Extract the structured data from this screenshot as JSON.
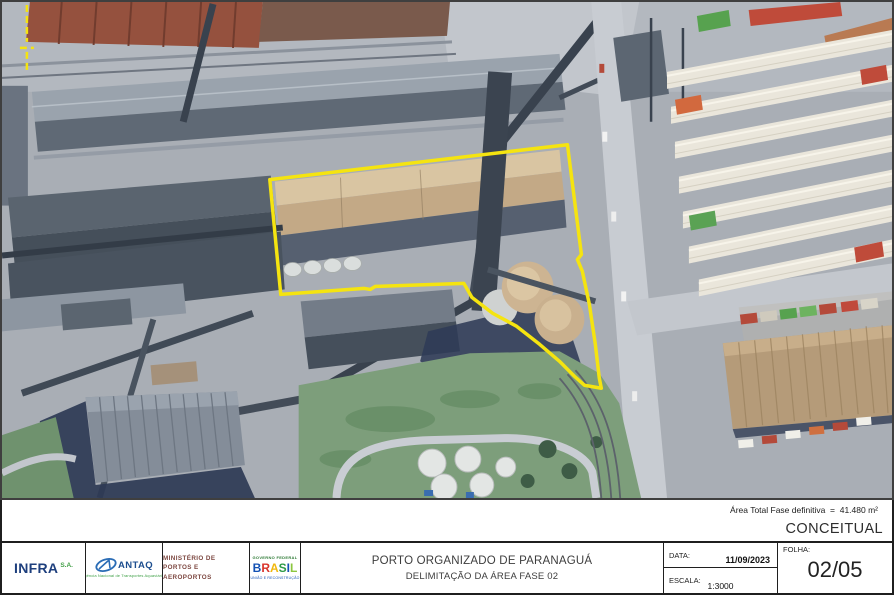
{
  "map": {
    "kind": "satellite-aerial-photo",
    "boundary_color": "#F5E410",
    "boundary_points": "269,178 568,143 582,253 578,258 583,270 590,303 596,343 600,377 602,387 585,384 575,375 560,360 540,343 517,325 493,312 472,296 464,282 375,285 370,288 364,287 280,293",
    "marker_path": "M25,3 L25,40 M25,50 L25,68 M18,46 L32,46"
  },
  "notes": {
    "area_total": "Área Total Fase definitiva  =  41.480 m²",
    "stage": "CONCEITUAL"
  },
  "title_block": {
    "title": "PORTO ORGANIZADO DE PARANAGUÁ",
    "subtitle": "DELIMITAÇÃO DA ÁREA FASE 02",
    "date_label": "DATA:",
    "date_value": "11/09/2023",
    "scale_label": "ESCALA:",
    "scale_value": "1:3000",
    "sheet_label": "FOLHA:",
    "sheet_value": "02/05"
  },
  "logos": {
    "infra": {
      "name": "INFRA",
      "suffix": "S.A.",
      "name_color": "#1e3f7d",
      "suffix_color": "#45a049"
    },
    "antaq": {
      "name": "ANTAQ",
      "tagline": "Agência Nacional de Transportes Aquaviários",
      "name_color": "#1d4e8f",
      "tagline_color": "#3fa047"
    },
    "ministerio": {
      "line1": "MINISTÉRIO DE",
      "line2": "PORTOS E AEROPORTOS",
      "color": "#7c4740"
    },
    "governo": {
      "top": "GOVERNO FEDERAL",
      "letters": [
        "B",
        "R",
        "A",
        "S",
        "I",
        "L"
      ],
      "letter_colors": [
        "#1351b4",
        "#d9342b",
        "#f1b80e",
        "#2d9a47",
        "#1351b4",
        "#8cc63f"
      ],
      "bottom": "UNIÃO E RECONSTRUÇÃO",
      "top_color": "#2d7a35",
      "bottom_color": "#1351b4"
    }
  }
}
